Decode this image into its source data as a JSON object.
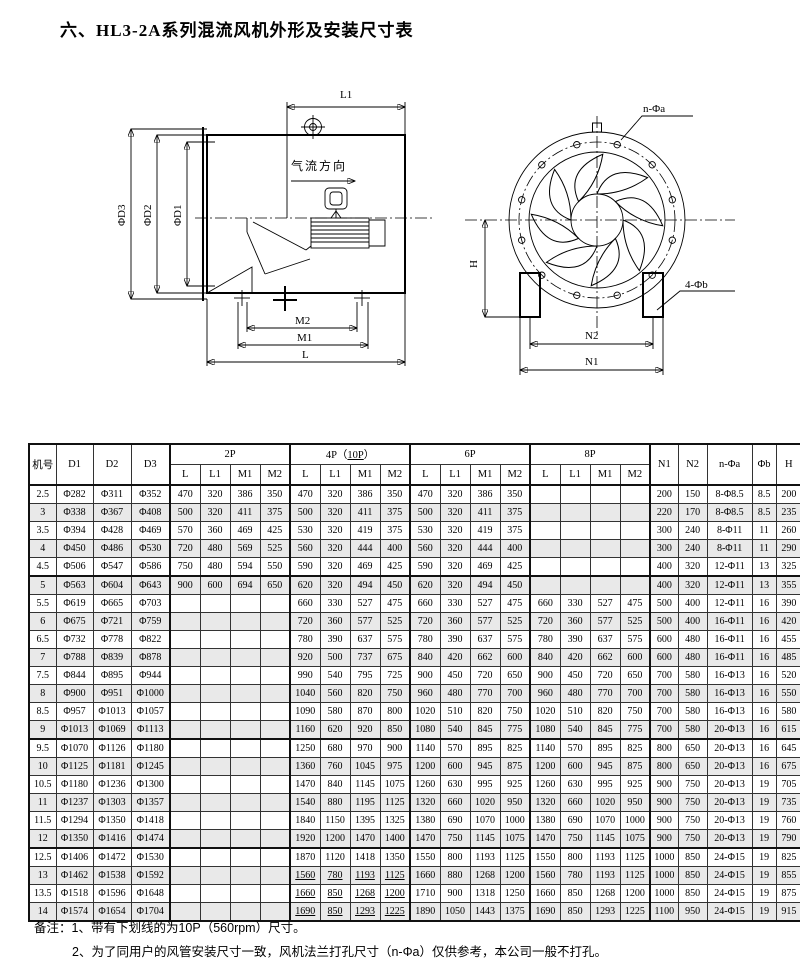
{
  "title": "六、HL3-2A系列混流风机外形及安装尺寸表",
  "drawings": {
    "side_view": {
      "airflow_label": "气流方向",
      "dim_l1": "L1",
      "dim_d3": "ΦD3",
      "dim_d2": "ΦD2",
      "dim_d1": "ΦD1",
      "dim_m2": "M2",
      "dim_m1": "M1",
      "dim_l": "L"
    },
    "front_view": {
      "dim_n_phi_a": "n-Φa",
      "dim_h": "H",
      "dim_4_phi_b": "4-Φb",
      "dim_n2": "N2",
      "dim_n1": "N1"
    }
  },
  "table": {
    "col_headers": {
      "model": "机号",
      "d1": "D1",
      "d2": "D2",
      "d3": "D3",
      "p2": "2P",
      "p4_prefix": "4P（",
      "p4_mid": "10P",
      "p4_suffix": "）",
      "p6": "6P",
      "p8": "8P",
      "n1": "N1",
      "n2": "N2",
      "na": "n-Φa",
      "phib": "Φb",
      "h": "H",
      "sub": [
        "L",
        "L1",
        "M1",
        "M2"
      ]
    },
    "underline_p4_rows": [
      21,
      22,
      23
    ],
    "rows": [
      [
        "2.5",
        "Φ282",
        "Φ311",
        "Φ352",
        "470",
        "320",
        "386",
        "350",
        "470",
        "320",
        "386",
        "350",
        "470",
        "320",
        "386",
        "350",
        "",
        "",
        "",
        "",
        "200",
        "150",
        "8-Φ8.5",
        "8.5",
        "200"
      ],
      [
        "3",
        "Φ338",
        "Φ367",
        "Φ408",
        "500",
        "320",
        "411",
        "375",
        "500",
        "320",
        "411",
        "375",
        "500",
        "320",
        "411",
        "375",
        "",
        "",
        "",
        "",
        "220",
        "170",
        "8-Φ8.5",
        "8.5",
        "235"
      ],
      [
        "3.5",
        "Φ394",
        "Φ428",
        "Φ469",
        "570",
        "360",
        "469",
        "425",
        "530",
        "320",
        "419",
        "375",
        "530",
        "320",
        "419",
        "375",
        "",
        "",
        "",
        "",
        "300",
        "240",
        "8-Φ11",
        "11",
        "260"
      ],
      [
        "4",
        "Φ450",
        "Φ486",
        "Φ530",
        "720",
        "480",
        "569",
        "525",
        "560",
        "320",
        "444",
        "400",
        "560",
        "320",
        "444",
        "400",
        "",
        "",
        "",
        "",
        "300",
        "240",
        "8-Φ11",
        "11",
        "290"
      ],
      [
        "4.5",
        "Φ506",
        "Φ547",
        "Φ586",
        "750",
        "480",
        "594",
        "550",
        "590",
        "320",
        "469",
        "425",
        "590",
        "320",
        "469",
        "425",
        "",
        "",
        "",
        "",
        "400",
        "320",
        "12-Φ11",
        "13",
        "325"
      ],
      [
        "5",
        "Φ563",
        "Φ604",
        "Φ643",
        "900",
        "600",
        "694",
        "650",
        "620",
        "320",
        "494",
        "450",
        "620",
        "320",
        "494",
        "450",
        "",
        "",
        "",
        "",
        "400",
        "320",
        "12-Φ11",
        "13",
        "355"
      ],
      [
        "5.5",
        "Φ619",
        "Φ665",
        "Φ703",
        "",
        "",
        "",
        "",
        "660",
        "330",
        "527",
        "475",
        "660",
        "330",
        "527",
        "475",
        "660",
        "330",
        "527",
        "475",
        "500",
        "400",
        "12-Φ11",
        "16",
        "390"
      ],
      [
        "6",
        "Φ675",
        "Φ721",
        "Φ759",
        "",
        "",
        "",
        "",
        "720",
        "360",
        "577",
        "525",
        "720",
        "360",
        "577",
        "525",
        "720",
        "360",
        "577",
        "525",
        "500",
        "400",
        "16-Φ11",
        "16",
        "420"
      ],
      [
        "6.5",
        "Φ732",
        "Φ778",
        "Φ822",
        "",
        "",
        "",
        "",
        "780",
        "390",
        "637",
        "575",
        "780",
        "390",
        "637",
        "575",
        "780",
        "390",
        "637",
        "575",
        "600",
        "480",
        "16-Φ11",
        "16",
        "455"
      ],
      [
        "7",
        "Φ788",
        "Φ839",
        "Φ878",
        "",
        "",
        "",
        "",
        "920",
        "500",
        "737",
        "675",
        "840",
        "420",
        "662",
        "600",
        "840",
        "420",
        "662",
        "600",
        "600",
        "480",
        "16-Φ11",
        "16",
        "485"
      ],
      [
        "7.5",
        "Φ844",
        "Φ895",
        "Φ944",
        "",
        "",
        "",
        "",
        "990",
        "540",
        "795",
        "725",
        "900",
        "450",
        "720",
        "650",
        "900",
        "450",
        "720",
        "650",
        "700",
        "580",
        "16-Φ13",
        "16",
        "520"
      ],
      [
        "8",
        "Φ900",
        "Φ951",
        "Φ1000",
        "",
        "",
        "",
        "",
        "1040",
        "560",
        "820",
        "750",
        "960",
        "480",
        "770",
        "700",
        "960",
        "480",
        "770",
        "700",
        "700",
        "580",
        "16-Φ13",
        "16",
        "550"
      ],
      [
        "8.5",
        "Φ957",
        "Φ1013",
        "Φ1057",
        "",
        "",
        "",
        "",
        "1090",
        "580",
        "870",
        "800",
        "1020",
        "510",
        "820",
        "750",
        "1020",
        "510",
        "820",
        "750",
        "700",
        "580",
        "16-Φ13",
        "16",
        "580"
      ],
      [
        "9",
        "Φ1013",
        "Φ1069",
        "Φ1113",
        "",
        "",
        "",
        "",
        "1160",
        "620",
        "920",
        "850",
        "1080",
        "540",
        "845",
        "775",
        "1080",
        "540",
        "845",
        "775",
        "700",
        "580",
        "20-Φ13",
        "16",
        "615"
      ],
      [
        "9.5",
        "Φ1070",
        "Φ1126",
        "Φ1180",
        "",
        "",
        "",
        "",
        "1250",
        "680",
        "970",
        "900",
        "1140",
        "570",
        "895",
        "825",
        "1140",
        "570",
        "895",
        "825",
        "800",
        "650",
        "20-Φ13",
        "16",
        "645"
      ],
      [
        "10",
        "Φ1125",
        "Φ1181",
        "Φ1245",
        "",
        "",
        "",
        "",
        "1360",
        "760",
        "1045",
        "975",
        "1200",
        "600",
        "945",
        "875",
        "1200",
        "600",
        "945",
        "875",
        "800",
        "650",
        "20-Φ13",
        "16",
        "675"
      ],
      [
        "10.5",
        "Φ1180",
        "Φ1236",
        "Φ1300",
        "",
        "",
        "",
        "",
        "1470",
        "840",
        "1145",
        "1075",
        "1260",
        "630",
        "995",
        "925",
        "1260",
        "630",
        "995",
        "925",
        "900",
        "750",
        "20-Φ13",
        "19",
        "705"
      ],
      [
        "11",
        "Φ1237",
        "Φ1303",
        "Φ1357",
        "",
        "",
        "",
        "",
        "1540",
        "880",
        "1195",
        "1125",
        "1320",
        "660",
        "1020",
        "950",
        "1320",
        "660",
        "1020",
        "950",
        "900",
        "750",
        "20-Φ13",
        "19",
        "735"
      ],
      [
        "11.5",
        "Φ1294",
        "Φ1350",
        "Φ1418",
        "",
        "",
        "",
        "",
        "1840",
        "1150",
        "1395",
        "1325",
        "1380",
        "690",
        "1070",
        "1000",
        "1380",
        "690",
        "1070",
        "1000",
        "900",
        "750",
        "20-Φ13",
        "19",
        "760"
      ],
      [
        "12",
        "Φ1350",
        "Φ1416",
        "Φ1474",
        "",
        "",
        "",
        "",
        "1920",
        "1200",
        "1470",
        "1400",
        "1470",
        "750",
        "1145",
        "1075",
        "1470",
        "750",
        "1145",
        "1075",
        "900",
        "750",
        "20-Φ13",
        "19",
        "790"
      ],
      [
        "12.5",
        "Φ1406",
        "Φ1472",
        "Φ1530",
        "",
        "",
        "",
        "",
        "1870",
        "1120",
        "1418",
        "1350",
        "1550",
        "800",
        "1193",
        "1125",
        "1550",
        "800",
        "1193",
        "1125",
        "1000",
        "850",
        "24-Φ15",
        "19",
        "825"
      ],
      [
        "13",
        "Φ1462",
        "Φ1538",
        "Φ1592",
        "",
        "",
        "",
        "",
        "1560",
        "780",
        "1193",
        "1125",
        "1660",
        "880",
        "1268",
        "1200",
        "1560",
        "780",
        "1193",
        "1125",
        "1000",
        "850",
        "24-Φ15",
        "19",
        "855"
      ],
      [
        "13.5",
        "Φ1518",
        "Φ1596",
        "Φ1648",
        "",
        "",
        "",
        "",
        "1660",
        "850",
        "1268",
        "1200",
        "1710",
        "900",
        "1318",
        "1250",
        "1660",
        "850",
        "1268",
        "1200",
        "1000",
        "850",
        "24-Φ15",
        "19",
        "875"
      ],
      [
        "14",
        "Φ1574",
        "Φ1654",
        "Φ1704",
        "",
        "",
        "",
        "",
        "1690",
        "850",
        "1293",
        "1225",
        "1890",
        "1050",
        "1443",
        "1375",
        "1690",
        "850",
        "1293",
        "1225",
        "1100",
        "950",
        "24-Φ15",
        "19",
        "915"
      ]
    ]
  },
  "notes": {
    "label": "备注：",
    "line1": "1、带有下划线的为10P（560rpm）尺寸。",
    "line2": "2、为了同用户的风管安装尺寸一致，风机法兰打孔尺寸（n-Φa）仅供参考，本公司一般不打孔。"
  }
}
